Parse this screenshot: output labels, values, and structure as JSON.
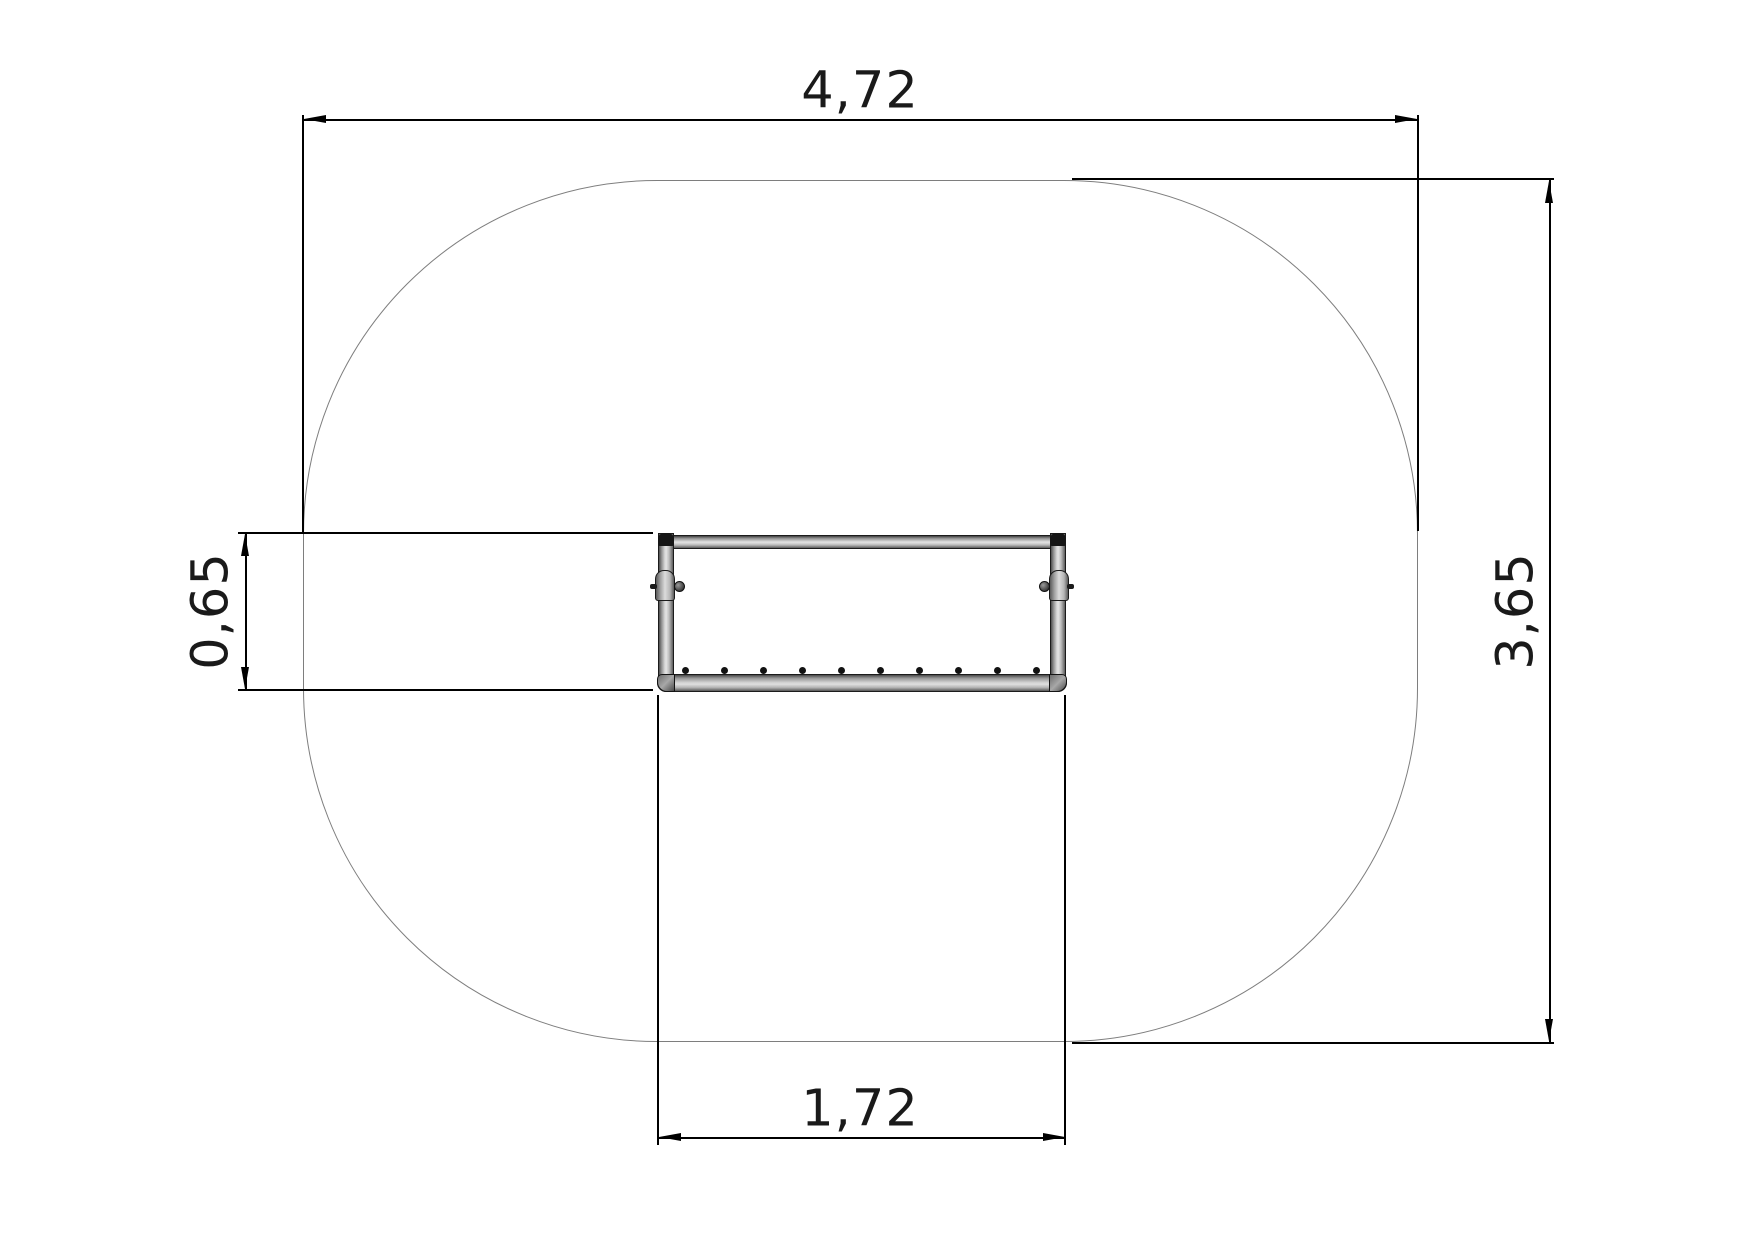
{
  "drawing": {
    "background_color": "#ffffff",
    "dimension_line_color": "#000000",
    "text_color": "#1a1a1a",
    "safety_zone": {
      "outline_color": "#7e7e7e"
    },
    "bench": {
      "tube_highlight_color": "#e0e0e0",
      "tube_mid_color": "#b5b5b5",
      "tube_shadow_color": "#4a4a4a",
      "outline_color": "#1b1b1b",
      "bolt_count": 10
    },
    "dimensions": {
      "overall_width": "4,72",
      "overall_height": "3,65",
      "equipment_width": "1,72",
      "equipment_depth": "0,65"
    }
  }
}
